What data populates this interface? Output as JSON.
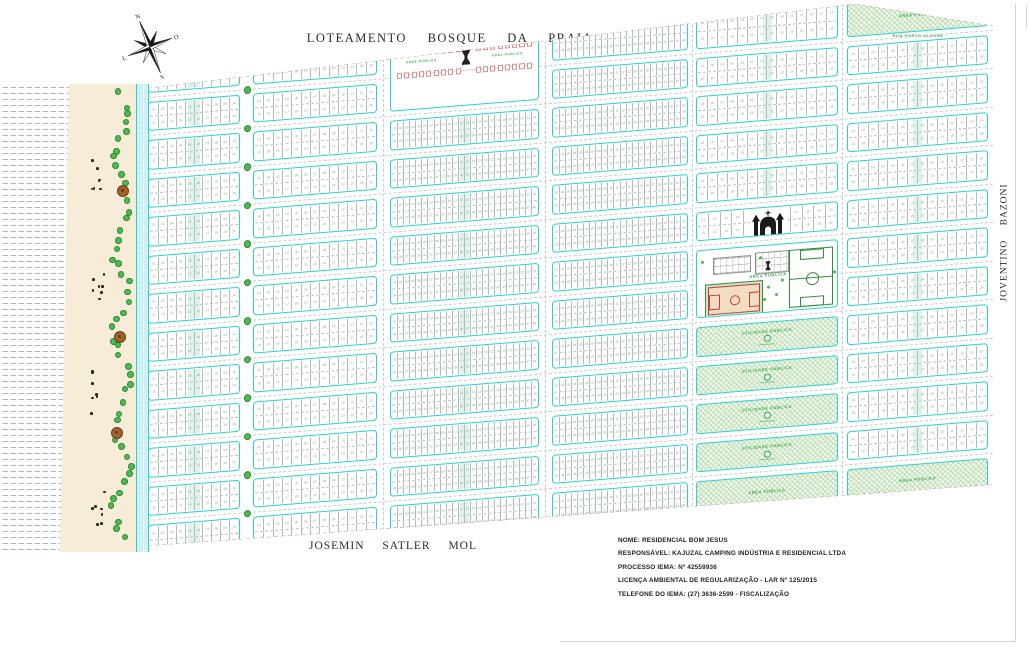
{
  "title": "LOTEAMENTO BOSQUE DA PRAIA",
  "streets": {
    "bottom": "JOSEMIN SATLER MOL",
    "right": "JOVENTINO BAZONI",
    "top_right": "RUA PORTO ALEGRE"
  },
  "compass": {
    "letters": {
      "top": "N",
      "right": "O",
      "left": "L",
      "bottom": "S"
    }
  },
  "info_block": {
    "lines": [
      "NOME: RESIDENCIAL BOM JESUS",
      "RESPONSÁVEL: KAJUZAL CAMPING INDÚSTRIA E RESIDENCIAL LTDA",
      "PROCESSO IEMA: Nº 42559936",
      "LICENÇA AMBIENTAL DE REGULARIZAÇÃO - LAR Nº 125/2015",
      "TELEFONE DO IEMA: (27) 3636-2599 - FISCALIZAÇÃO"
    ]
  },
  "labels": {
    "utilidade_publica": "UTILIDADE PÚBLICA",
    "area_publica": "ÁREA PÚBLICA"
  },
  "palette": {
    "street_border": "#2ad0d4",
    "road_fill": "#cdf2f4",
    "hatch_green": "#76bc6e",
    "label_green": "#3cab49",
    "sand": "#f6ecd8",
    "ocean_dash": "#a9b5d2",
    "plaza_pink": "#d98f8f",
    "boundary_dash": "#c09898",
    "tree_green": "#4cbb4f",
    "shrub_black": "#262626",
    "tree_brown": "#a0622d"
  },
  "map": {
    "street_centers_y": [
      97,
      135.5,
      174,
      212.5,
      251,
      289.5,
      328,
      366.5,
      405,
      443.5,
      482,
      520.5
    ],
    "street_half": 4.5,
    "top_row_y": 58,
    "bottom_row_y": 556,
    "columns": [
      {
        "x": 0,
        "w": 92,
        "lots": 10,
        "strip": 12
      },
      {
        "x": 105,
        "w": 124,
        "lots": 13,
        "strip": 0
      },
      {
        "x": 242,
        "w": 149,
        "lots": 24,
        "strip": 9
      },
      {
        "x": 404,
        "w": 136,
        "lots": 22,
        "strip": 0
      },
      {
        "x": 548,
        "w": 142,
        "lots": 14,
        "strip": 9
      },
      {
        "x": 699,
        "w": 141,
        "lots": 14,
        "strip": 9
      }
    ],
    "boulevard_center_x": 98.5,
    "street_centers_x": [
      235.5,
      397.5,
      544,
      694.5
    ],
    "specials": {
      "plaza": {
        "col": 2,
        "row_top": 0,
        "row_bottom": 1
      },
      "church": {
        "col": 4,
        "row": 5
      },
      "recreation": {
        "col": 4,
        "row_top": 6,
        "row_bottom": 7
      },
      "green_blocks": {
        "col": 4,
        "rows": [
          8,
          9,
          10,
          11
        ]
      },
      "top_wedge": {
        "col": 5,
        "row": 0
      },
      "bottom_wedges": [
        {
          "col": 4,
          "row": 12
        },
        {
          "col": 5,
          "row": 12
        }
      ]
    },
    "scatter": {
      "green_count": 50,
      "shrub_clusters": [
        140,
        250,
        370,
        488
      ],
      "shrubs_per_cluster": 7,
      "brown_trees": [
        [
          122,
          190
        ],
        [
          119,
          336
        ],
        [
          116,
          432
        ]
      ],
      "seed": 7
    }
  }
}
